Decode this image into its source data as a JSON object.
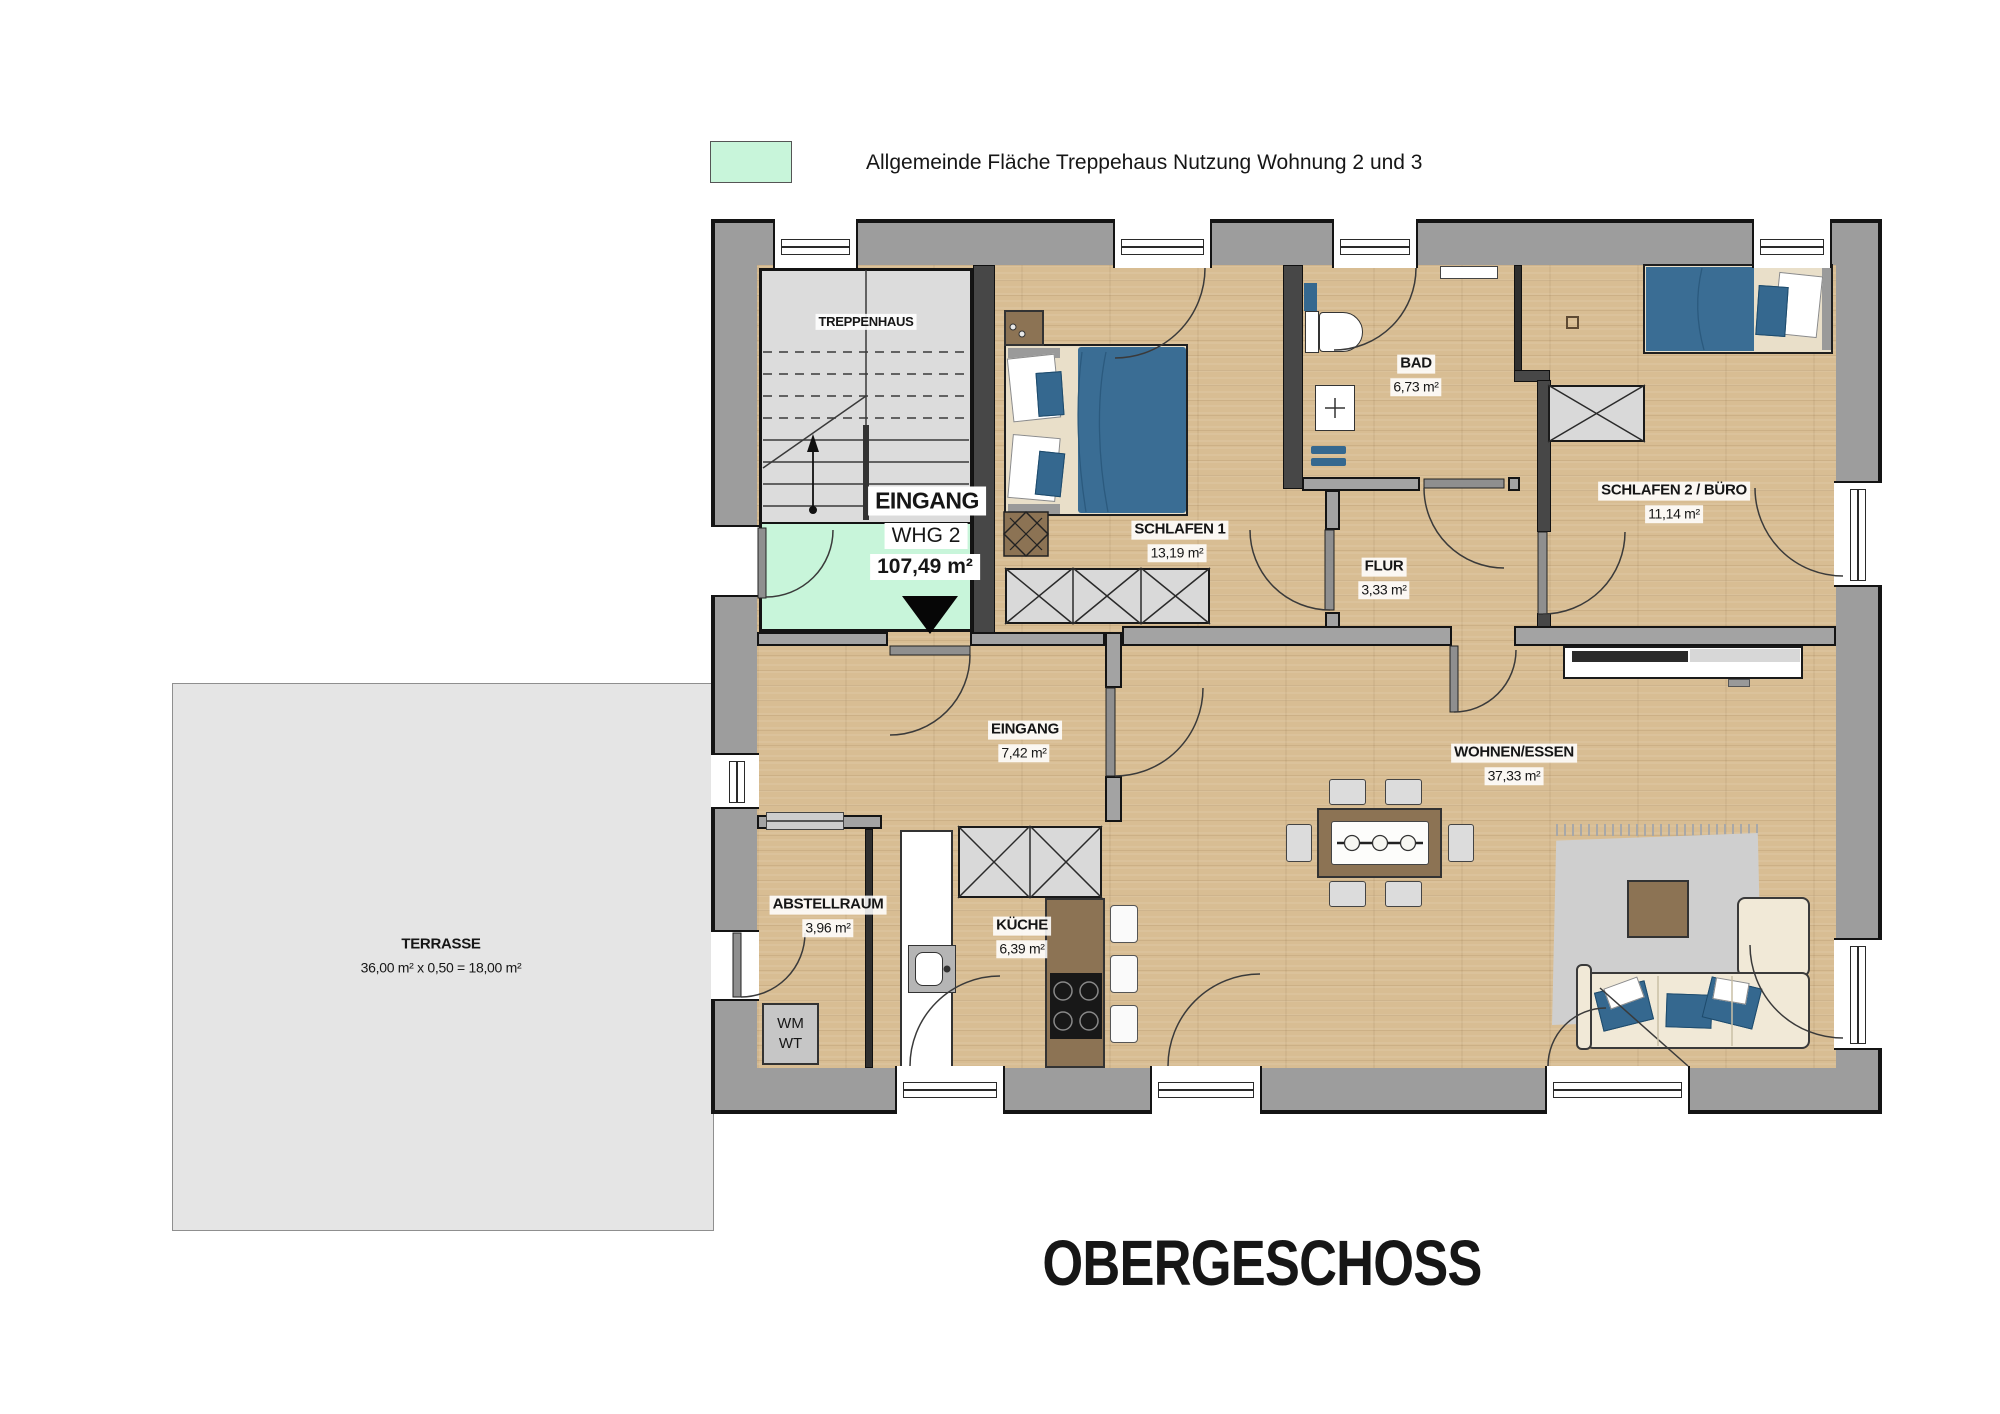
{
  "legend": {
    "swatch_color": "#c8f5da",
    "label": "Allgemeinde Fläche Treppehaus Nutzung Wohnung 2 und 3"
  },
  "title": "OBERGESCHOSS",
  "rooms": {
    "treppenhaus": {
      "name": "TREPPENHAUS"
    },
    "whg2_entry": {
      "line1": "EINGANG",
      "line2": "WHG 2",
      "area": "107,49 m²"
    },
    "schlafen1": {
      "name": "SCHLAFEN 1",
      "area": "13,19 m²"
    },
    "bad": {
      "name": "BAD",
      "area": "6,73 m²"
    },
    "schlafen2": {
      "name": "SCHLAFEN 2 / BÜRO",
      "area": "11,14 m²"
    },
    "flur": {
      "name": "FLUR",
      "area": "3,33 m²"
    },
    "eingang": {
      "name": "EINGANG",
      "area": "7,42 m²"
    },
    "wohnen": {
      "name": "WOHNEN/ESSEN",
      "area": "37,33 m²"
    },
    "abstellraum": {
      "name": "ABSTELLRAUM",
      "area": "3,96 m²"
    },
    "kueche": {
      "name": "KÜCHE",
      "area": "6,39 m²"
    },
    "terrasse": {
      "name": "TERRASSE",
      "area": "36,00 m² x 0,50 = 18,00 m²"
    },
    "wm_wt": {
      "line1": "WM",
      "line2": "WT"
    }
  },
  "colors": {
    "common_area": "#c8f5da",
    "wall": "#9d9d9d",
    "wood_floor": "#d8bd93",
    "stair_floor": "#dcdcdc",
    "terrace": "#e5e5e5",
    "accent_blue": "#35688f",
    "furniture_brown": "#8c7354"
  }
}
